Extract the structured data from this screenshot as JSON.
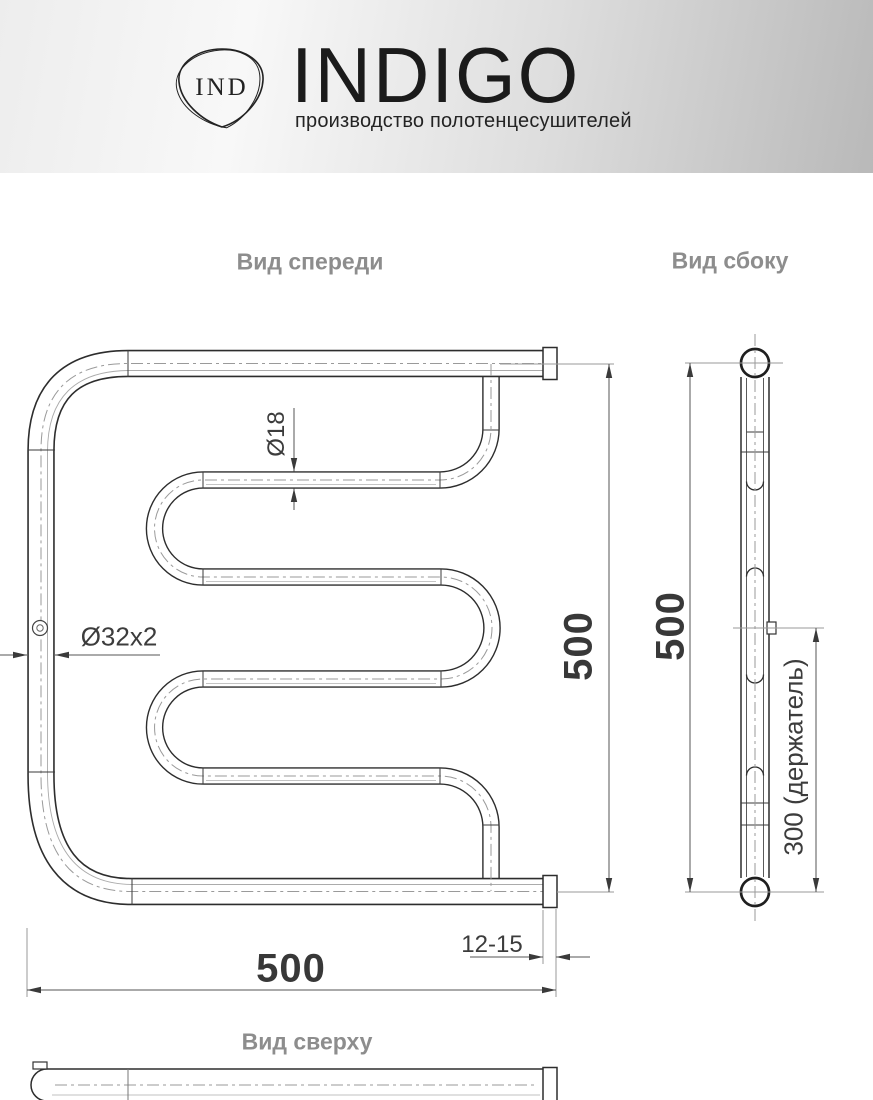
{
  "header": {
    "brand": "INDIGO",
    "monogram": "IND",
    "tagline": "производство полотенцесушителей"
  },
  "view_labels": {
    "front": "Вид спереди",
    "side": "Вид сбоку",
    "top": "Вид сверху"
  },
  "dimensions": {
    "height_front": "500",
    "width_front": "500",
    "height_side": "500",
    "coil_pipe_diameter": "Ø18",
    "main_pipe_diameter": "Ø32x2",
    "wall_clearance": "12-15",
    "holder_spacing": "300 (держатель)"
  },
  "colors": {
    "pipe_line": "#2d2d2d",
    "thin_line": "#9a9a9a",
    "dim_line": "#555555",
    "dim_text": "#3c3c3c",
    "label_gray": "#8d8d8d",
    "header_gradient_light": "#f8f8f8",
    "header_gradient_dark": "#b9b9b9"
  }
}
